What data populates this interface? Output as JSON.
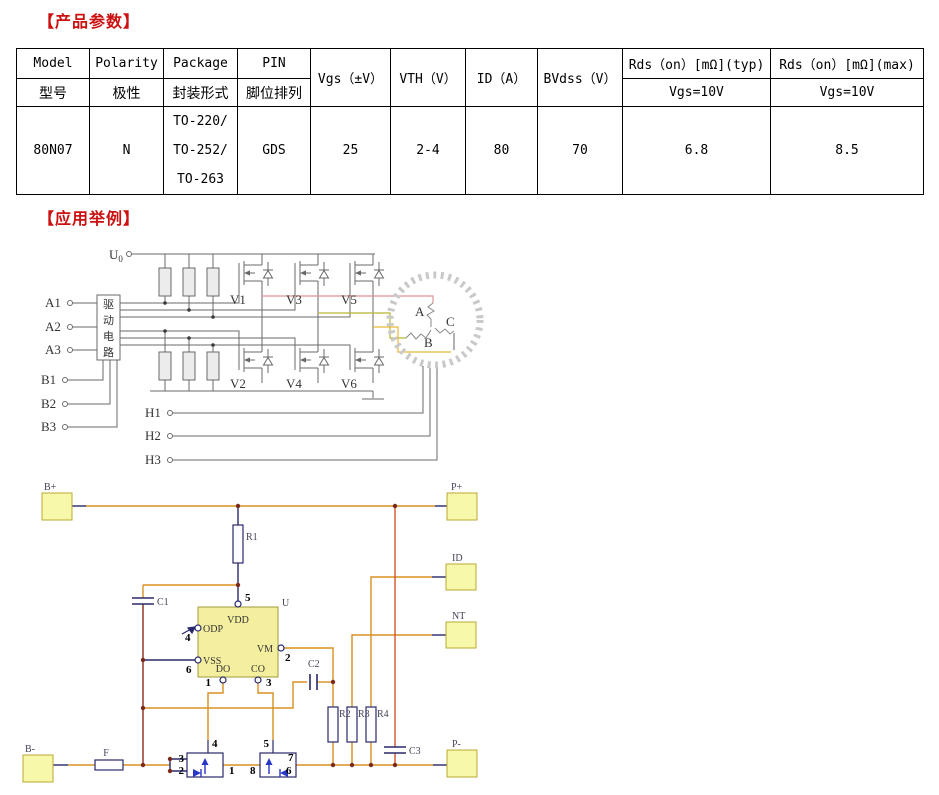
{
  "titles": {
    "product_params": "【产品参数】",
    "application_examples": "【应用举例】",
    "title_color": "#cc1111"
  },
  "table": {
    "col_headers_en": [
      "Model",
      "Polarity",
      "Package",
      "PIN"
    ],
    "col_headers_cn": [
      "型号",
      "极性",
      "封装形式",
      "脚位排列"
    ],
    "span_headers": [
      "Vgs（±V）",
      "VTH（V）",
      "ID（A）",
      "BVdss（V）"
    ],
    "rds_typ_header": "Rds（on）[mΩ](typ)",
    "rds_max_header": "Rds（on）[mΩ](max)",
    "rds_typ_cond": "Vgs=10V",
    "rds_max_cond": "Vgs=10V",
    "row": {
      "model": "80N07",
      "polarity": "N",
      "package_lines": [
        "TO-220/",
        "TO-252/",
        "TO-263"
      ],
      "pin": "GDS",
      "vgs": "25",
      "vth": "2-4",
      "id": "80",
      "bvdss": "70",
      "rds_typ": "6.8",
      "rds_max": "8.5"
    }
  },
  "circuit1": {
    "supply_main": "U",
    "supply_sub": "0",
    "inputs_a": [
      "A1",
      "A2",
      "A3"
    ],
    "inputs_b": [
      "B1",
      "B2",
      "B3"
    ],
    "hall": [
      "H1",
      "H2",
      "H3"
    ],
    "driver_chars": [
      "驱",
      "动",
      "电",
      "路"
    ],
    "mosfets_top": [
      "V1",
      "V3",
      "V5"
    ],
    "mosfets_bottom": [
      "V2",
      "V4",
      "V6"
    ],
    "motor_windings": [
      "A",
      "B",
      "C"
    ],
    "colors": {
      "wire": "#6a6a6a",
      "phase_a": "#e09595",
      "phase_b": "#b8b830",
      "phase_c": "#e8b838",
      "motor_ring": "#c9c9c9"
    }
  },
  "circuit2": {
    "pads": {
      "bplus": "B+",
      "pplus": "P+",
      "id": "ID",
      "nt": "NT",
      "bminus": "B-",
      "pminus": "P-"
    },
    "ic": {
      "ref": "U",
      "vdd": "VDD",
      "vm": "VM",
      "odp": "ODP",
      "vss": "VSS",
      "dout": "DO",
      "cout": "CO",
      "pin_vdd": "5",
      "pin_vm": "2",
      "pin_odp": "4",
      "pin_vss": "6",
      "pin_do": "1",
      "pin_co": "3"
    },
    "resistors": {
      "r1": "R1",
      "r2": "R2",
      "r3": "R3",
      "r4": "R4"
    },
    "capacitors": {
      "c1": "C1",
      "c2": "C2",
      "c3": "C3"
    },
    "fuse": "F",
    "q1_pins": {
      "gate": "4",
      "left_top": "3",
      "left_bottom": "2",
      "right": "1"
    },
    "q2_pins": {
      "gate": "5",
      "left": "8",
      "right": "6",
      "top_right": "7"
    },
    "colors": {
      "wire": "#d89020",
      "rail": "#8a2a1a",
      "hot": "#d2522a",
      "component": "#28286a",
      "body_blue": "#2936c8",
      "pad_fill": "#f8f8aa",
      "pad_stroke": "#b8a830",
      "ic_fill": "#f4ef9e",
      "ic_stroke": "#a29a38"
    }
  }
}
